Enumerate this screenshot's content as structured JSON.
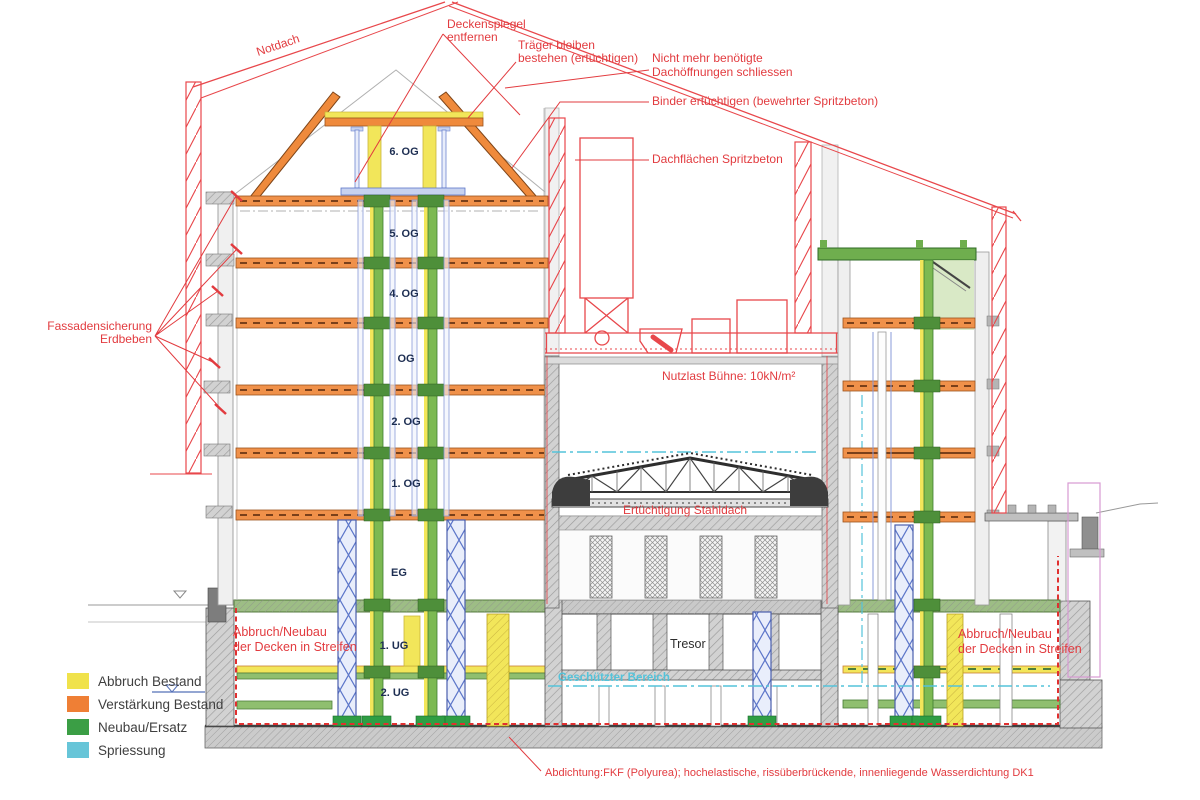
{
  "annotations": {
    "notdach": "Notdach",
    "deckenspiegel": [
      "Deckenspiegel",
      "entfernen"
    ],
    "traeger": [
      "Träger bleiben",
      "bestehen (ertüchtigen)"
    ],
    "dachoeffnungen": [
      "Nicht mehr benötigte",
      "Dachöffnungen schliessen"
    ],
    "binder": "Binder ertüchtigen (bewehrter Spritzbeton)",
    "dachflaechen": "Dachflächen Spritzbeton",
    "fassadensicherung": [
      "Fassadensicherung",
      "Erdbeben"
    ],
    "nutzlast": "Nutzlast Bühne: 10kN/m²",
    "stahldach": "Ertüchtigung Stahldach",
    "abbruch_links": [
      "Abbruch/Neubau",
      "der Decken in Streifen"
    ],
    "abbruch_rechts": [
      "Abbruch/Neubau",
      "der Decken in Streifen"
    ],
    "tresor": "Tresor",
    "geschuetzter_bereich": "Geschützter Bereich",
    "abdichtung": "Abdichtung:FKF (Polyurea); hochelastische, rissüberbrückende, innenliegende Wasserdichtung DK1"
  },
  "floor_labels": [
    "6. OG",
    "5. OG",
    "4. OG",
    "OG",
    "2. OG",
    "1. OG",
    "EG",
    "1. UG",
    "2. UG"
  ],
  "legend": {
    "items": [
      {
        "label": "Abbruch Bestand",
        "color": "#f0e24b"
      },
      {
        "label": "Verstärkung Bestand",
        "color": "#ef7f35"
      },
      {
        "label": "Neubau/Ersatz",
        "color": "#3b9e45"
      },
      {
        "label": "Spriessung",
        "color": "#67c5d8"
      }
    ]
  },
  "colors": {
    "annotation_red": "#e23b3f",
    "scaffold_red": "#e8474b",
    "reinforce_orange": "#f0914a",
    "demolish_yellow": "#f2e65a",
    "new_green": "#7cb952",
    "shoring_blue": "#5c76c9",
    "protected_cyan": "#54c3da",
    "existing_gray": "#9a9a9a",
    "label_navy": "#1d2e52"
  }
}
